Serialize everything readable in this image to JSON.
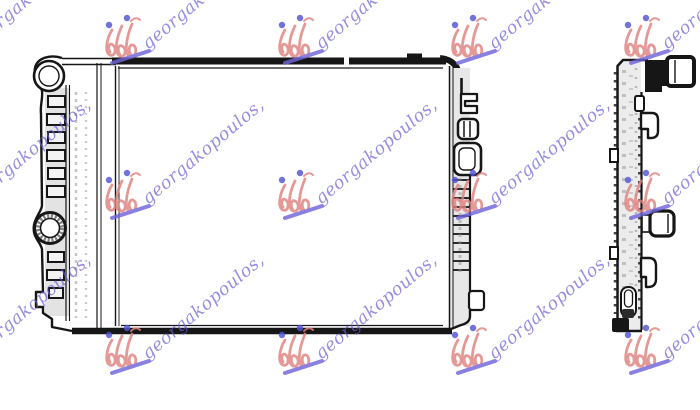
{
  "page": {
    "background_color": "#ffffff"
  },
  "watermark": {
    "text": "georgakopoulos,",
    "text_color": "#6a5ed2",
    "logo_color": "#e0837f",
    "dot_color": "#5353d6",
    "underline_color": "#6f64d8",
    "opacity": 0.82
  },
  "drawing": {
    "line_color": "#161616",
    "tank_fill": "#e7e7e7",
    "body_fill": "#ececec"
  }
}
